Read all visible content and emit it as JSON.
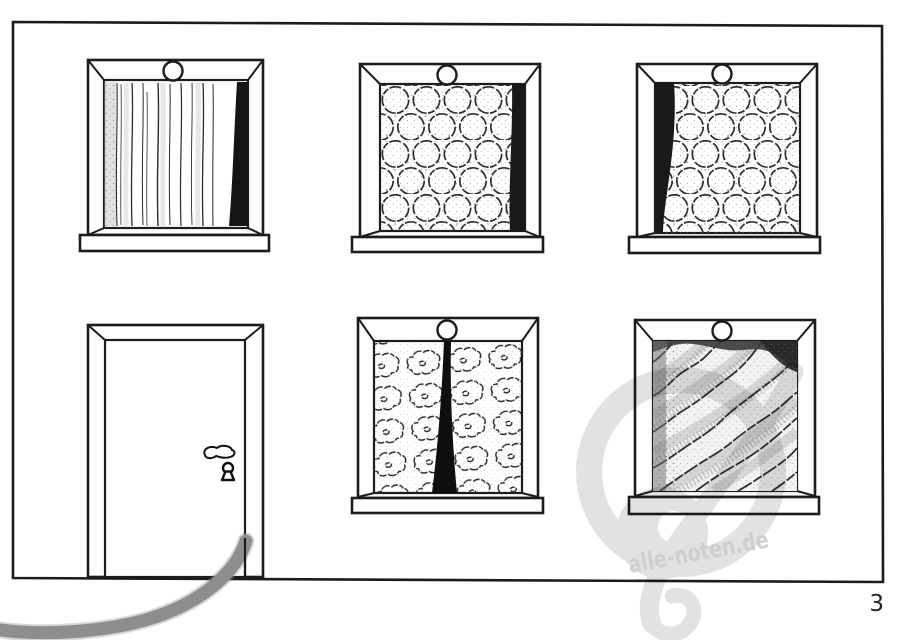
{
  "page": {
    "number": "3"
  },
  "watermark": {
    "text": "alle-noten.de"
  },
  "colors": {
    "paper": "#ffffff",
    "ink": "#1c1c1c",
    "swoosh_gray": "#8e8e8e",
    "watermark_clef_gray": "#e2e2e2",
    "watermark_text_gray": "#cfcfcf"
  },
  "scene": {
    "windows": [
      {
        "position": "top-left",
        "curtain_pattern": "vertical-stripes"
      },
      {
        "position": "top-middle",
        "curtain_pattern": "rings"
      },
      {
        "position": "top-right",
        "curtain_pattern": "rings"
      },
      {
        "position": "bottom-middle",
        "curtain_pattern": "flowers-center-split"
      },
      {
        "position": "bottom-right",
        "curtain_pattern": "diagonal-waves"
      }
    ],
    "door": {
      "features": "handle, keyhole"
    }
  }
}
